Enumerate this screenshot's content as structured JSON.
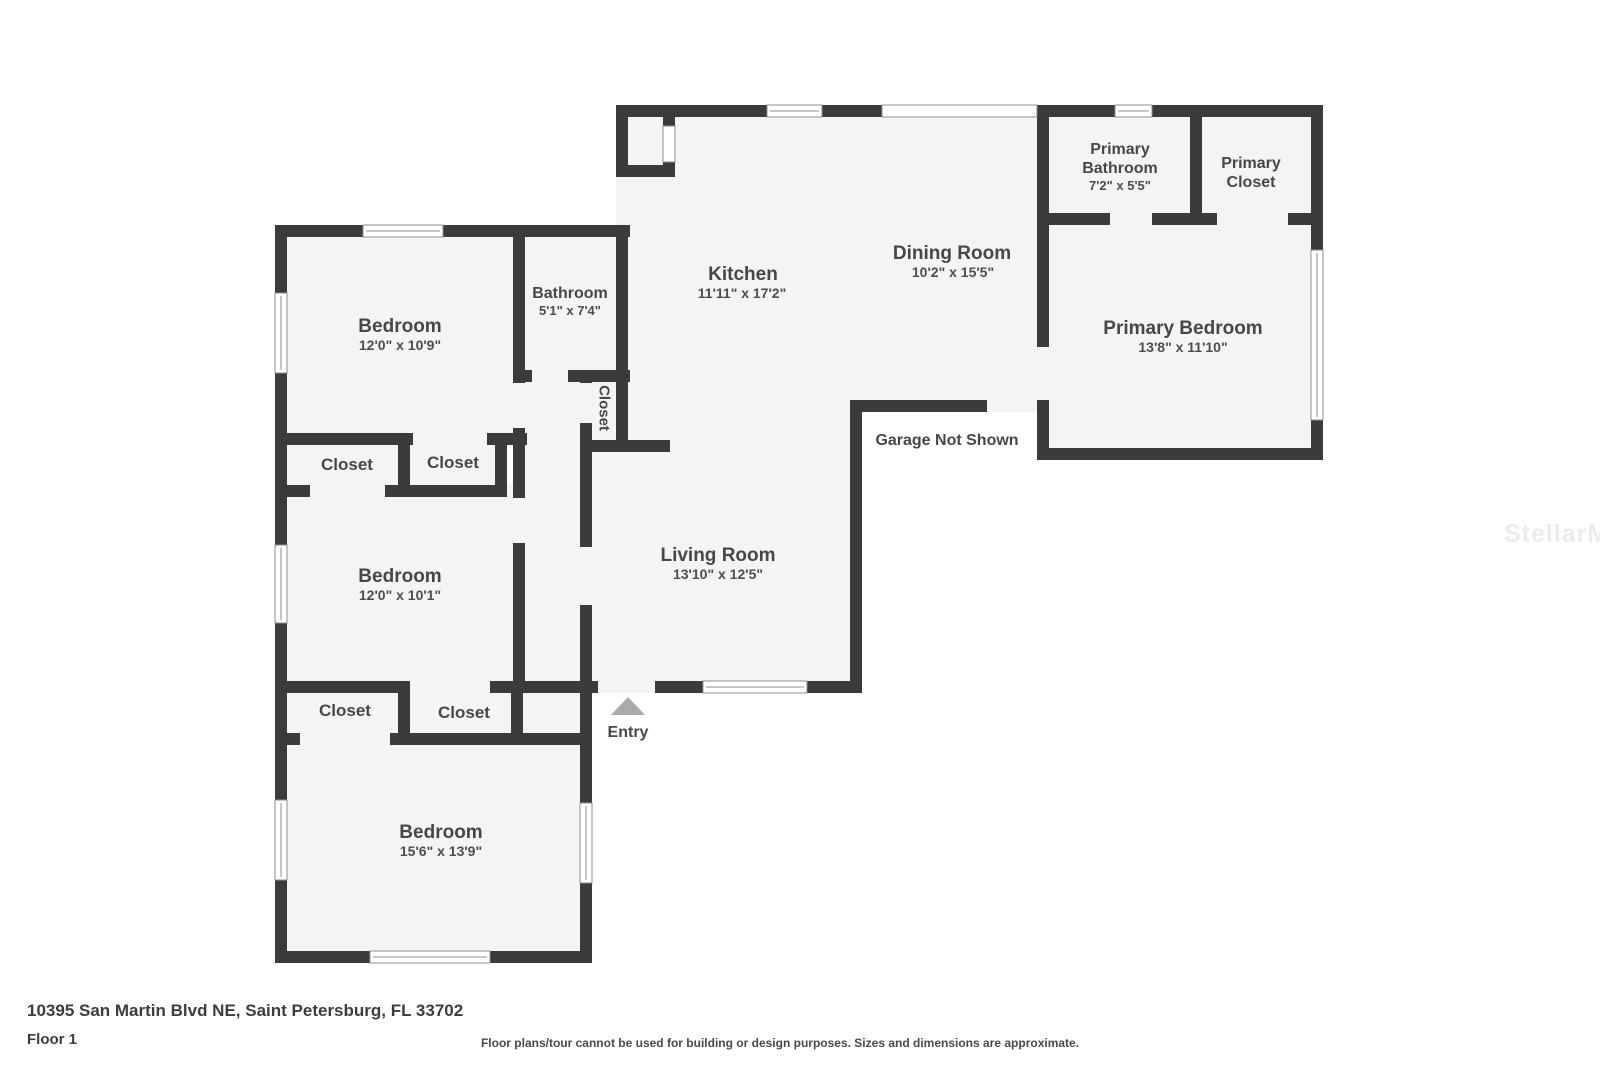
{
  "watermark": "StellarMLS",
  "footer": {
    "address": "10395 San Martin Blvd NE, Saint Petersburg, FL 33702",
    "floor": "Floor 1",
    "disclaimer": "Floor plans/tour cannot be used for building or design purposes. Sizes and dimensions are approximate."
  },
  "annotations": {
    "garage": "Garage Not Shown",
    "entry": "Entry"
  },
  "rooms": {
    "kitchen": {
      "name": "Kitchen",
      "dims": "11'11\" x 17'2\""
    },
    "dining": {
      "name": "Dining Room",
      "dims": "10'2\" x 15'5\""
    },
    "living": {
      "name": "Living Room",
      "dims": "13'10\" x 12'5\""
    },
    "primary_bedroom": {
      "name": "Primary Bedroom",
      "dims": "13'8\" x 11'10\""
    },
    "primary_bathroom": {
      "name_line1": "Primary",
      "name_line2": "Bathroom",
      "dims": "7'2\" x 5'5\""
    },
    "primary_closet": {
      "name_line1": "Primary",
      "name_line2": "Closet"
    },
    "bedroom1": {
      "name": "Bedroom",
      "dims": "12'0\" x 10'9\""
    },
    "bedroom2": {
      "name": "Bedroom",
      "dims": "12'0\" x 10'1\""
    },
    "bedroom3": {
      "name": "Bedroom",
      "dims": "15'6\" x 13'9\""
    },
    "bathroom": {
      "name": "Bathroom",
      "dims": "5'1\" x 7'4\""
    },
    "closet_hall": {
      "name": "Closet"
    },
    "closet_row1_left": {
      "name": "Closet"
    },
    "closet_row1_right": {
      "name": "Closet"
    },
    "closet_row2_left": {
      "name": "Closet"
    },
    "closet_row2_right": {
      "name": "Closet"
    }
  },
  "colors": {
    "wall": "#3b3b3b",
    "room_fill": "#f4f4f4",
    "label_text": "#474747",
    "watermark": "#ebebeb",
    "entry_arrow": "#aaaaaa"
  }
}
